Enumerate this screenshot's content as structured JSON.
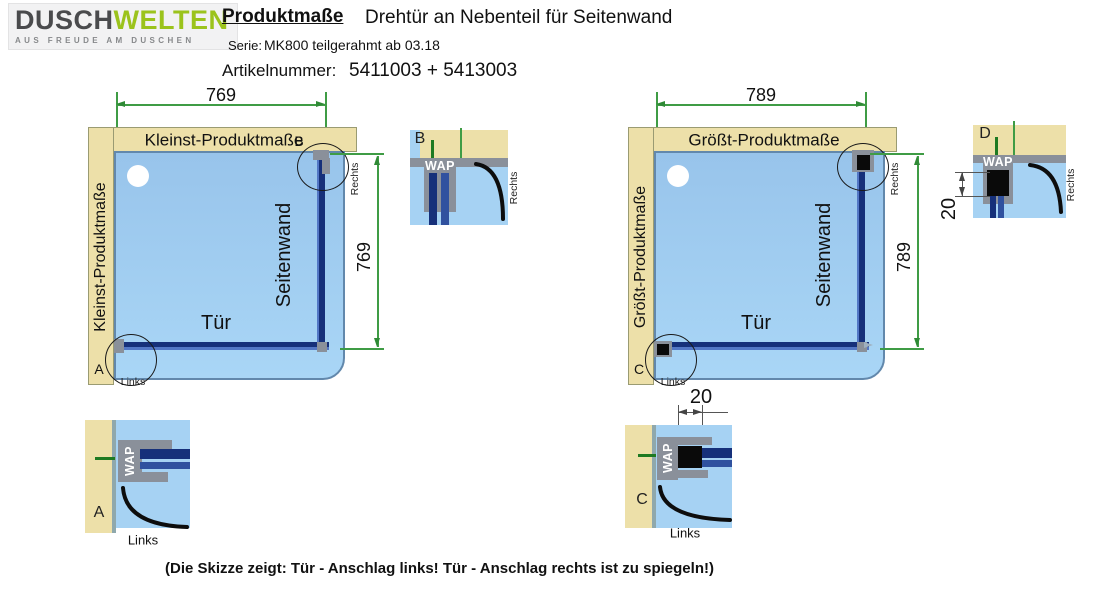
{
  "header": {
    "logo_primary": "DUSCH",
    "logo_secondary": "WELTEN",
    "logo_tagline": "AUS FREUDE AM DUSCHEN",
    "doc_title": "Produktmaße",
    "doc_subtitle": "Drehtür an Nebenteil für Seitenwand",
    "series_label": "Serie:",
    "series_value": "MK800 teilgerahmt ab 03.18",
    "article_label": "Artikelnummer:",
    "article_value": "5411003 + 5413003"
  },
  "diagrams": [
    {
      "size_label": "Kleinst-Produktmaße",
      "width_dim": "769",
      "height_dim": "769",
      "side_panel_label": "Seitenwand",
      "door_label": "Tür",
      "right_label": "Rechts",
      "links_label": "Links",
      "top_circle_letter": "B",
      "bottom_corner_letter": "A"
    },
    {
      "size_label": "Größt-Produktmaße",
      "width_dim": "789",
      "height_dim": "789",
      "side_panel_label": "Seitenwand",
      "door_label": "Tür",
      "right_label": "Rechts",
      "links_label": "Links",
      "top_circle_letter": "",
      "bottom_corner_letter": "C"
    }
  ],
  "details": {
    "b": {
      "letter": "B",
      "profile_label": "WAP",
      "position_label": "Rechts"
    },
    "a": {
      "letter": "A",
      "profile_label": "WAP",
      "position_label": "Links"
    },
    "d": {
      "letter": "D",
      "profile_label": "WAP",
      "position_label": "Rechts",
      "adjust_dim": "20"
    },
    "c": {
      "letter": "C",
      "profile_label": "WAP",
      "position_label": "Links",
      "adjust_dim": "20"
    }
  },
  "footer": {
    "note": "(Die Skizze zeigt: Tür - Anschlag links! Tür - Anschlag rechts ist zu spiegeln!)"
  },
  "colors": {
    "wall_beige": "#EDE0A9",
    "tray_blue": "#A6D2F3",
    "glass_dark_blue": "#16307A",
    "profile_gray": "#8A909A",
    "dimension_green": "#3F9C45",
    "logo_green": "#9BC31C"
  }
}
